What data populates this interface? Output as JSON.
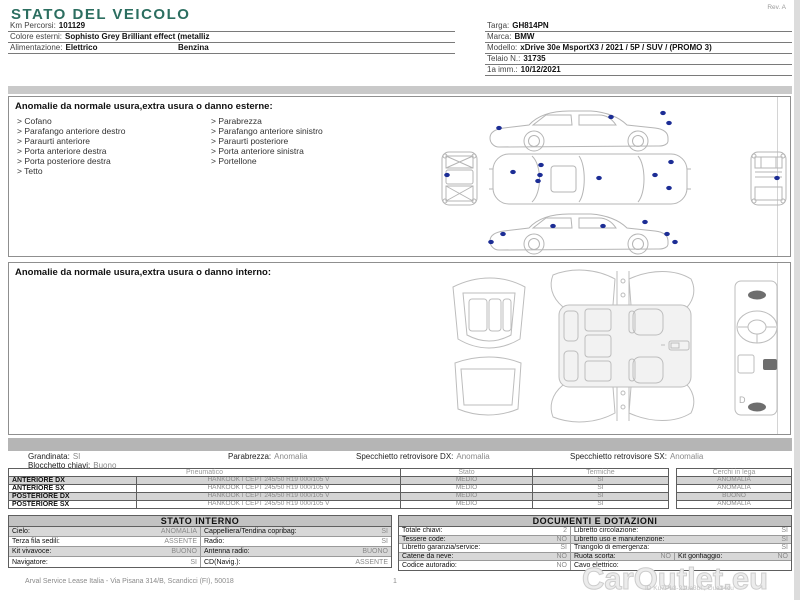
{
  "colors": {
    "title_teal": "#2c6e60",
    "damage_marker_blue": "#1c2d95",
    "band_gray": "#b5b5b5",
    "muted_value_gray": "#8a8a8a"
  },
  "header": {
    "title": "STATO DEL VEICOLO",
    "rev": "Rev. A"
  },
  "info_left": {
    "rows": [
      {
        "label": "Km Percorsi:",
        "value": "101129"
      },
      {
        "label": "Colore esterni:",
        "value": "Sophisto Grey Brilliant effect (metalliz"
      },
      {
        "label": "Alimentazione:",
        "value": "Elettrico",
        "value2": "Benzina"
      }
    ]
  },
  "info_right": {
    "rows": [
      {
        "label": "Targa:",
        "value": "GH814PN"
      },
      {
        "label": "Marca:",
        "value": "BMW"
      },
      {
        "label": "Modello:",
        "value": "xDrive 30e MsportX3 / 2021 / 5P / SUV / (PROMO 3)"
      },
      {
        "label": "Telaio N.:",
        "value": "31735"
      },
      {
        "label": "1a imm.:",
        "value": "10/12/2021"
      }
    ]
  },
  "exterior_section": {
    "title": "Anomalie da normale usura,extra usura o danno esterne:",
    "items_left": [
      "Cofano",
      "Parafango anteriore destro",
      "Paraurti anteriore",
      "Porta anteriore destra",
      "Porta posteriore destra",
      "Tetto"
    ],
    "items_right": [
      "Parabrezza",
      "Parafango anteriore sinistro",
      "Paraurti posteriore",
      "Porta anteriore sinistra",
      "Portellone"
    ]
  },
  "interior_section": {
    "title": "Anomalie da normale usura,extra usura o danno interno:",
    "dash_label": "D"
  },
  "status": {
    "row1": [
      {
        "label": "Grandinata:",
        "value": "SI"
      },
      {
        "label": "Parabrezza:",
        "value": "Anomalia"
      },
      {
        "label": "Specchietto retrovisore DX:",
        "value": "Anomalia"
      },
      {
        "label": "Specchietto retrovisore SX:",
        "value": "Anomalia"
      }
    ],
    "row2": {
      "label": "Blocchetto chiavi:",
      "value": "Buono"
    }
  },
  "tyres": {
    "headers": [
      "Pneumatico",
      "Stato",
      "Termiche",
      "Cerchi in lega"
    ],
    "rows": [
      {
        "position": "ANTERIORE DX",
        "tyre": "HANKOOK I CEPT 245/50 R19 000/105 V",
        "stato": "MEDIO",
        "termiche": "SI",
        "cerchi": "ANOMALIA"
      },
      {
        "position": "ANTERIORE SX",
        "tyre": "HANKOOK I CEPT 245/50 R19 000/105 V",
        "stato": "MEDIO",
        "termiche": "SI",
        "cerchi": "ANOMALIA"
      },
      {
        "position": "POSTERIORE DX",
        "tyre": "HANKOOK I CEPT 245/50 R19 000/105 V",
        "stato": "MEDIO",
        "termiche": "SI",
        "cerchi": "BUONO"
      },
      {
        "position": "POSTERIORE SX",
        "tyre": "HANKOOK I CEPT 245/50 R19 000/105 V",
        "stato": "MEDIO",
        "termiche": "SI",
        "cerchi": "ANOMALIA"
      }
    ]
  },
  "stato_interno": {
    "title": "STATO INTERNO",
    "rows": [
      {
        "l": {
          "label": "Cielo:",
          "value": "ANOMALIA"
        },
        "r": {
          "label": "Cappelliera/Tendina copribag:",
          "value": "SI"
        }
      },
      {
        "l": {
          "label": "Terza fila sedili:",
          "value": "ASSENTE"
        },
        "r": {
          "label": "Radio:",
          "value": "SI"
        }
      },
      {
        "l": {
          "label": "Kit vivavoce:",
          "value": "BUONO"
        },
        "r": {
          "label": "Antenna radio:",
          "value": "BUONO"
        }
      },
      {
        "l": {
          "label": "Navigatore:",
          "value": "SI"
        },
        "r": {
          "label": "CD(Navig.):",
          "value": "ASSENTE"
        }
      }
    ]
  },
  "documenti": {
    "title": "DOCUMENTI E DOTAZIONI",
    "rows": [
      {
        "l": {
          "label": "Totale chiavi:",
          "value": "2"
        },
        "r": {
          "label": "Libretto circolazione:",
          "value": "SI"
        }
      },
      {
        "l": {
          "label": "Tessere code:",
          "value": "NO"
        },
        "r": {
          "label": "Libretto uso e manutenzione:",
          "value": "SI"
        }
      },
      {
        "l": {
          "label": "Libretto garanzia/service:",
          "value": "SI"
        },
        "r": {
          "label": "Triangolo di emergenza:",
          "value": "SI"
        }
      },
      {
        "l": {
          "label": "Catene da neve:",
          "value": "NO"
        },
        "r": {
          "label": "Ruota scorta:",
          "value": "NO"
        },
        "r2": {
          "label": "Kit gonfiaggio:",
          "value": "NO"
        }
      },
      {
        "l": {
          "label": "Codice autoradio:",
          "value": "NO"
        },
        "r": {
          "label": "Cavo elettrico:",
          "value": ""
        }
      }
    ]
  },
  "footer": {
    "company": "Arval Service Lease Italia - Via Pisana 314/B, Scandicci (FI), 50018",
    "page": "1",
    "watermark": "CarOutlet.eu",
    "id_line": "ID Ku7Pu3-21ua3bI ; Oua14cu"
  }
}
